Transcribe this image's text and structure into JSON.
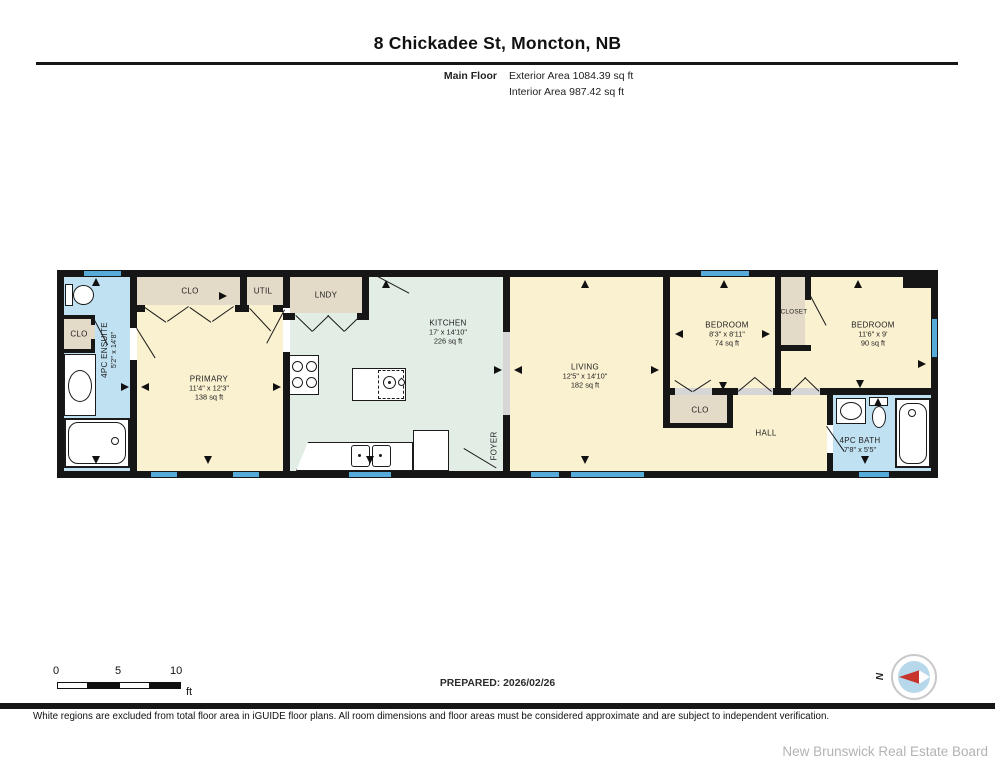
{
  "header": {
    "title": "8 Chickadee St, Moncton, NB",
    "floor_label": "Main Floor",
    "exterior_area": "Exterior Area 1084.39 sq ft",
    "interior_area": "Interior Area 987.42 sq ft"
  },
  "rooms": {
    "ensuite": {
      "name": "4PC ENSUITE",
      "dims": "5'2\" x 14'8\""
    },
    "clo_ensuite": {
      "name": "CLO"
    },
    "clo_primary": {
      "name": "CLO"
    },
    "util": {
      "name": "UTIL"
    },
    "primary": {
      "name": "PRIMARY",
      "dims": "11'4\" x 12'3\"",
      "area": "138 sq ft"
    },
    "lndy": {
      "name": "LNDY"
    },
    "kitchen": {
      "name": "KITCHEN",
      "dims": "17' x 14'10\"",
      "area": "226 sq ft"
    },
    "foyer": {
      "name": "FOYER"
    },
    "living": {
      "name": "LIVING",
      "dims": "12'5\" x 14'10\"",
      "area": "182 sq ft"
    },
    "bedroom1": {
      "name": "BEDROOM",
      "dims": "8'3\" x 8'11\"",
      "area": "74 sq ft"
    },
    "clo_hall": {
      "name": "CLO"
    },
    "closet": {
      "name": "CLOSET"
    },
    "bedroom2": {
      "name": "BEDROOM",
      "dims": "11'6\" x 9'",
      "area": "90 sq ft"
    },
    "hall": {
      "name": "HALL"
    },
    "bath": {
      "name": "4PC BATH",
      "dims": "7'8\" x 5'5\""
    }
  },
  "scale_bar": {
    "ticks": [
      "0",
      "5",
      "10"
    ],
    "unit": "ft"
  },
  "compass": {
    "north_label": "N"
  },
  "footer": {
    "prepared": "PREPARED: 2026/02/26",
    "disclaimer": "White regions are excluded from total floor area in iGUIDE floor plans. All room dimensions and floor areas must be considered approximate and are subject to independent verification.",
    "brand": "New Brunswick Real Estate Board"
  },
  "colors": {
    "wall": "#161616",
    "cream": "#faf1d0",
    "beige": "#e4dac8",
    "green": "#e2ede5",
    "bath_blue": "#bfe1f2",
    "window_blue": "#56abd9",
    "threshold": "#d6d6d6",
    "needle_red": "#c6342c",
    "compass_blue": "#b7d8ea"
  }
}
